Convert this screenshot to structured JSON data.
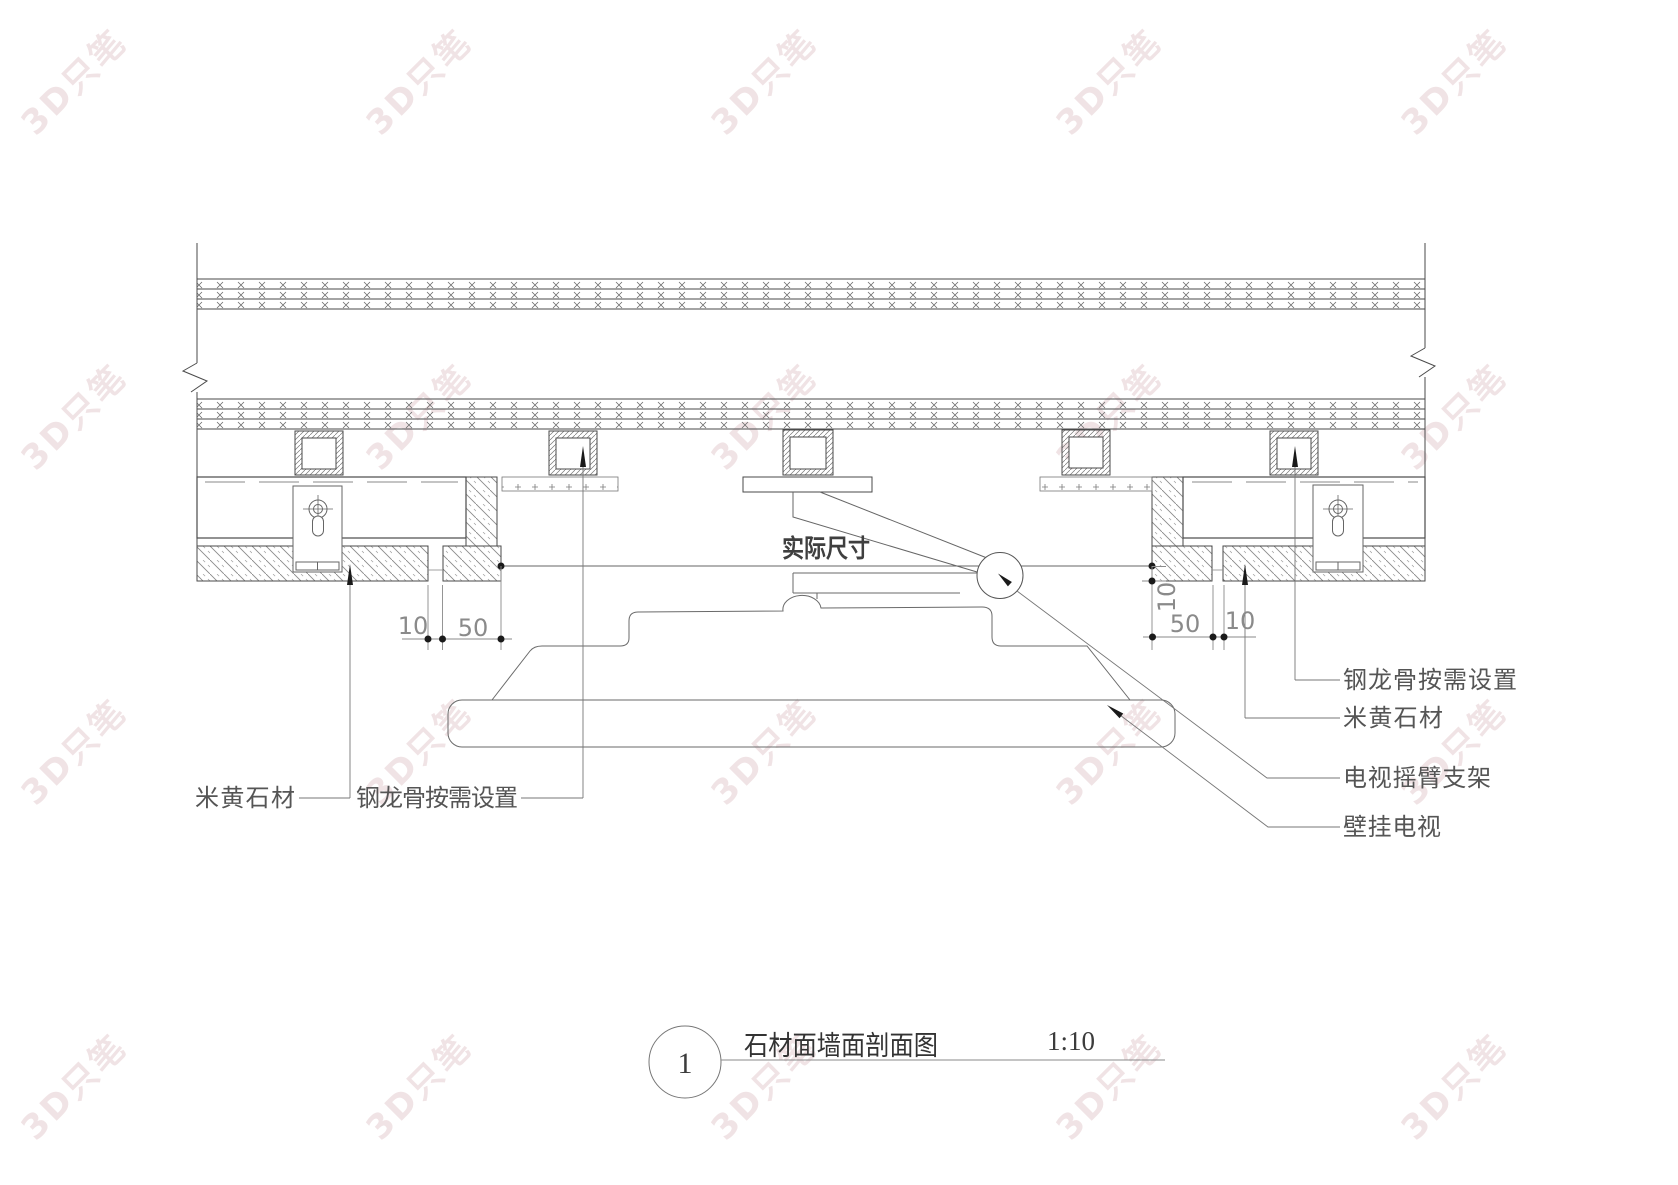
{
  "drawing": {
    "detail_number": "1",
    "title": "石材面墙面剖面图",
    "scale": "1:10",
    "annotation_actual_size": "实际尺寸",
    "labels": {
      "stone": "米黄石材",
      "keel": "钢龙骨按需设置",
      "tv_arm": "电视摇臂支架",
      "tv": "壁挂电视"
    },
    "dimensions": {
      "left_joint": "10",
      "left_return": "50",
      "right_return": "50",
      "right_joint": "10",
      "right_face_offset": "10"
    },
    "line_color": "#4a4a4a"
  },
  "watermark": {
    "text": "3D只笔",
    "color": "#eedfe1"
  }
}
